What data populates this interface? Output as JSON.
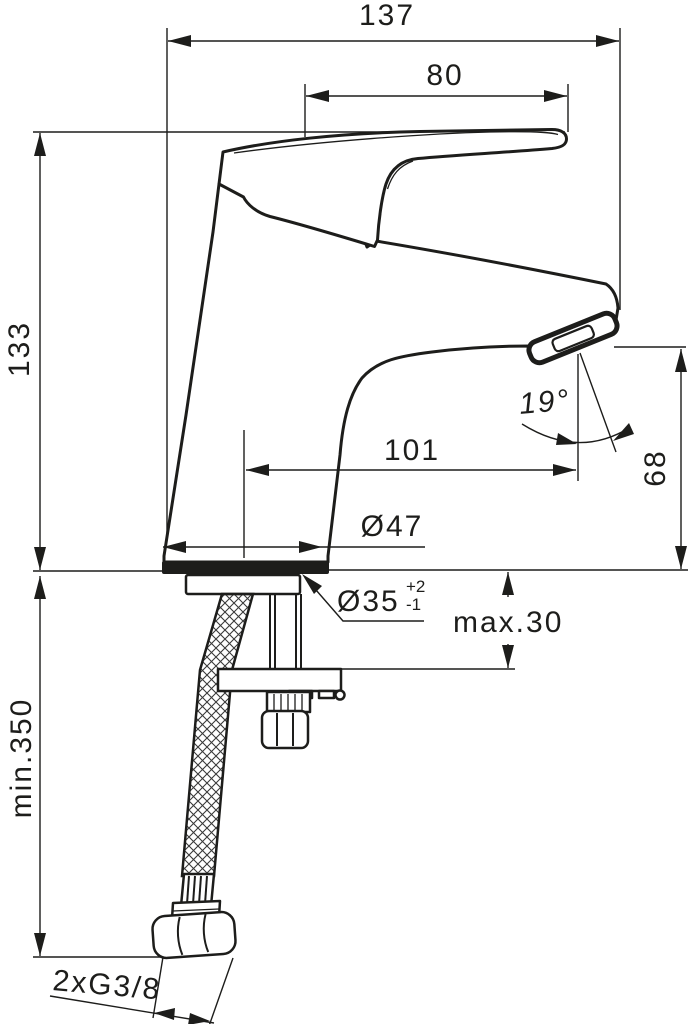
{
  "drawing": {
    "type": "technical-dimension-drawing",
    "subject": "single-lever basin mixer faucet, side view with installation dimensions",
    "background_color": "#ffffff",
    "line_color": "#1d1d1b",
    "dimensions": {
      "overall_width": "137",
      "lever_length": "80",
      "height_above_deck": "133",
      "spout_reach": "101",
      "spout_height": "68",
      "spout_angle": "19°",
      "base_diameter": "Ø47",
      "hole_diameter": "Ø35",
      "hole_tolerance_plus": "+2",
      "hole_tolerance_minus": "-1",
      "deck_thickness": "max.30",
      "hose_length": "min.350",
      "connection_thread": "2xG3/8"
    }
  }
}
